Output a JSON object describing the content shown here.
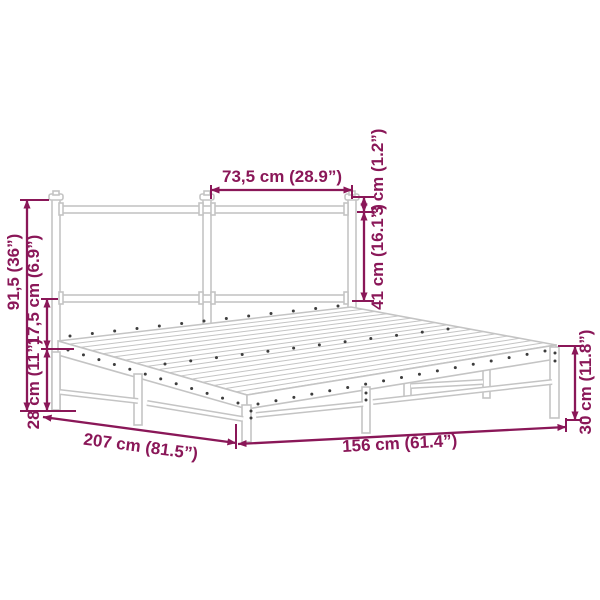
{
  "diagram": {
    "name": "bed-frame-dimension-diagram",
    "subject": "metal bed frame with headboard",
    "colors": {
      "dimension": "#8A1758",
      "frame_outline": "#C4C4C4",
      "hole_dot": "#3D3D3D",
      "background": "#FFFFFF"
    },
    "dimensions": {
      "headboard_section_width": {
        "label": "73,5 cm (28.9”)",
        "cm": 73.5,
        "inches": 28.9
      },
      "headboard_top_bar_thickness": {
        "label": "3 cm (1.2”)",
        "cm": 3,
        "inches": 1.2
      },
      "headboard_panel_height": {
        "label": "41 cm (16.1”)",
        "cm": 41,
        "inches": 16.1
      },
      "headboard_total_height": {
        "label": "91,5 (36”)",
        "cm": 91.5,
        "inches": 36
      },
      "headboard_to_rail_gap": {
        "label": "17,5 cm (6.9”)",
        "cm": 17.5,
        "inches": 6.9
      },
      "under_rail_clearance": {
        "label": "28 cm (11”)",
        "cm": 28,
        "inches": 11
      },
      "bed_length": {
        "label": "207 cm (81.5”)",
        "cm": 207,
        "inches": 81.5
      },
      "bed_width": {
        "label": "156 cm (61.4”)",
        "cm": 156,
        "inches": 61.4
      },
      "side_rail_height": {
        "label": "30 cm (11.8”)",
        "cm": 30,
        "inches": 11.8
      }
    }
  }
}
